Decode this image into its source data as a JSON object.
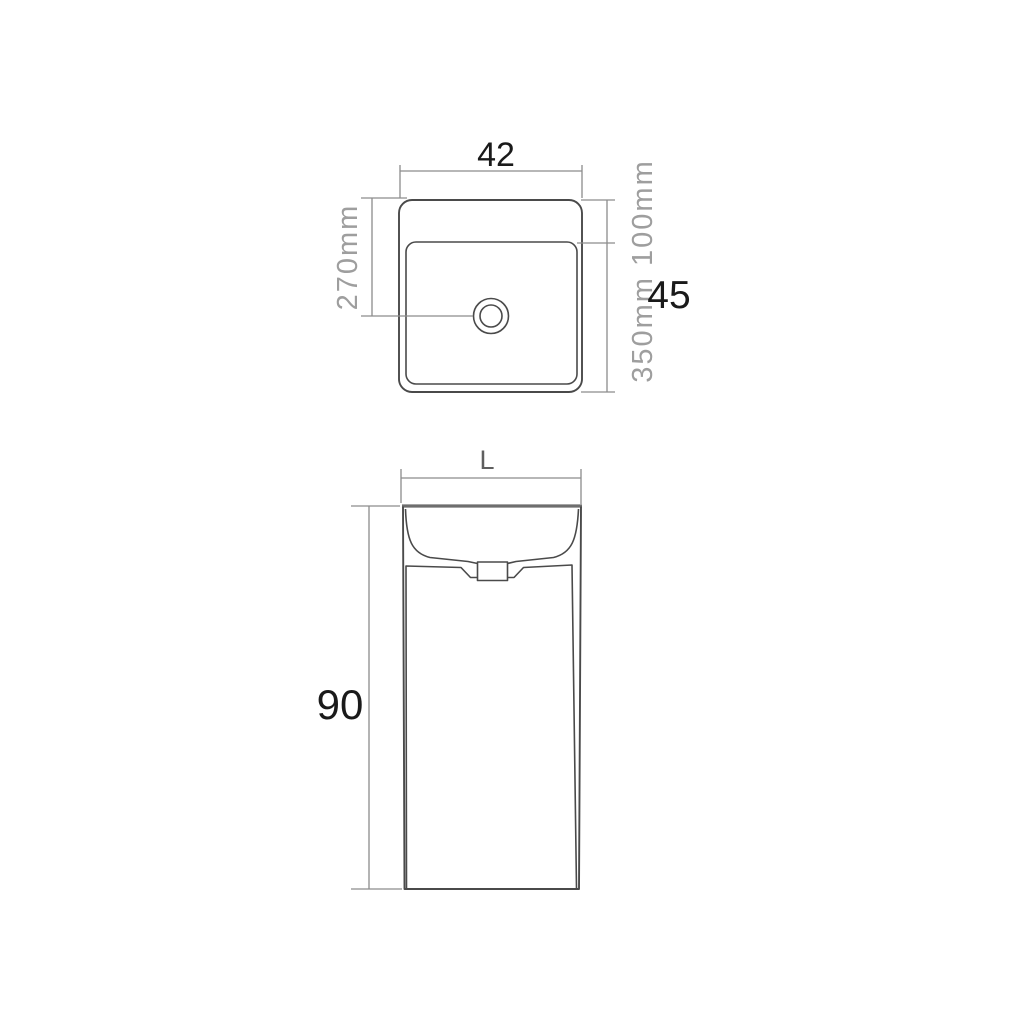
{
  "canvas": {
    "background": "#ffffff"
  },
  "colors": {
    "outline": "#4a4a4a",
    "rim_edge": "#6e6e6e",
    "dimension_lines": "#8c8c8c",
    "dimension_text_gray": "#9e9e9e",
    "dimension_text_dark": "#1a1a1a",
    "front_width_letter": "#5f5f5f"
  },
  "top_view": {
    "dims": {
      "overall_width": "42",
      "drain_offset": "270mm",
      "depth_split": "350mm 100mm",
      "overall_depth": "45"
    }
  },
  "front_view": {
    "dims": {
      "width": "L",
      "height": "90"
    }
  }
}
